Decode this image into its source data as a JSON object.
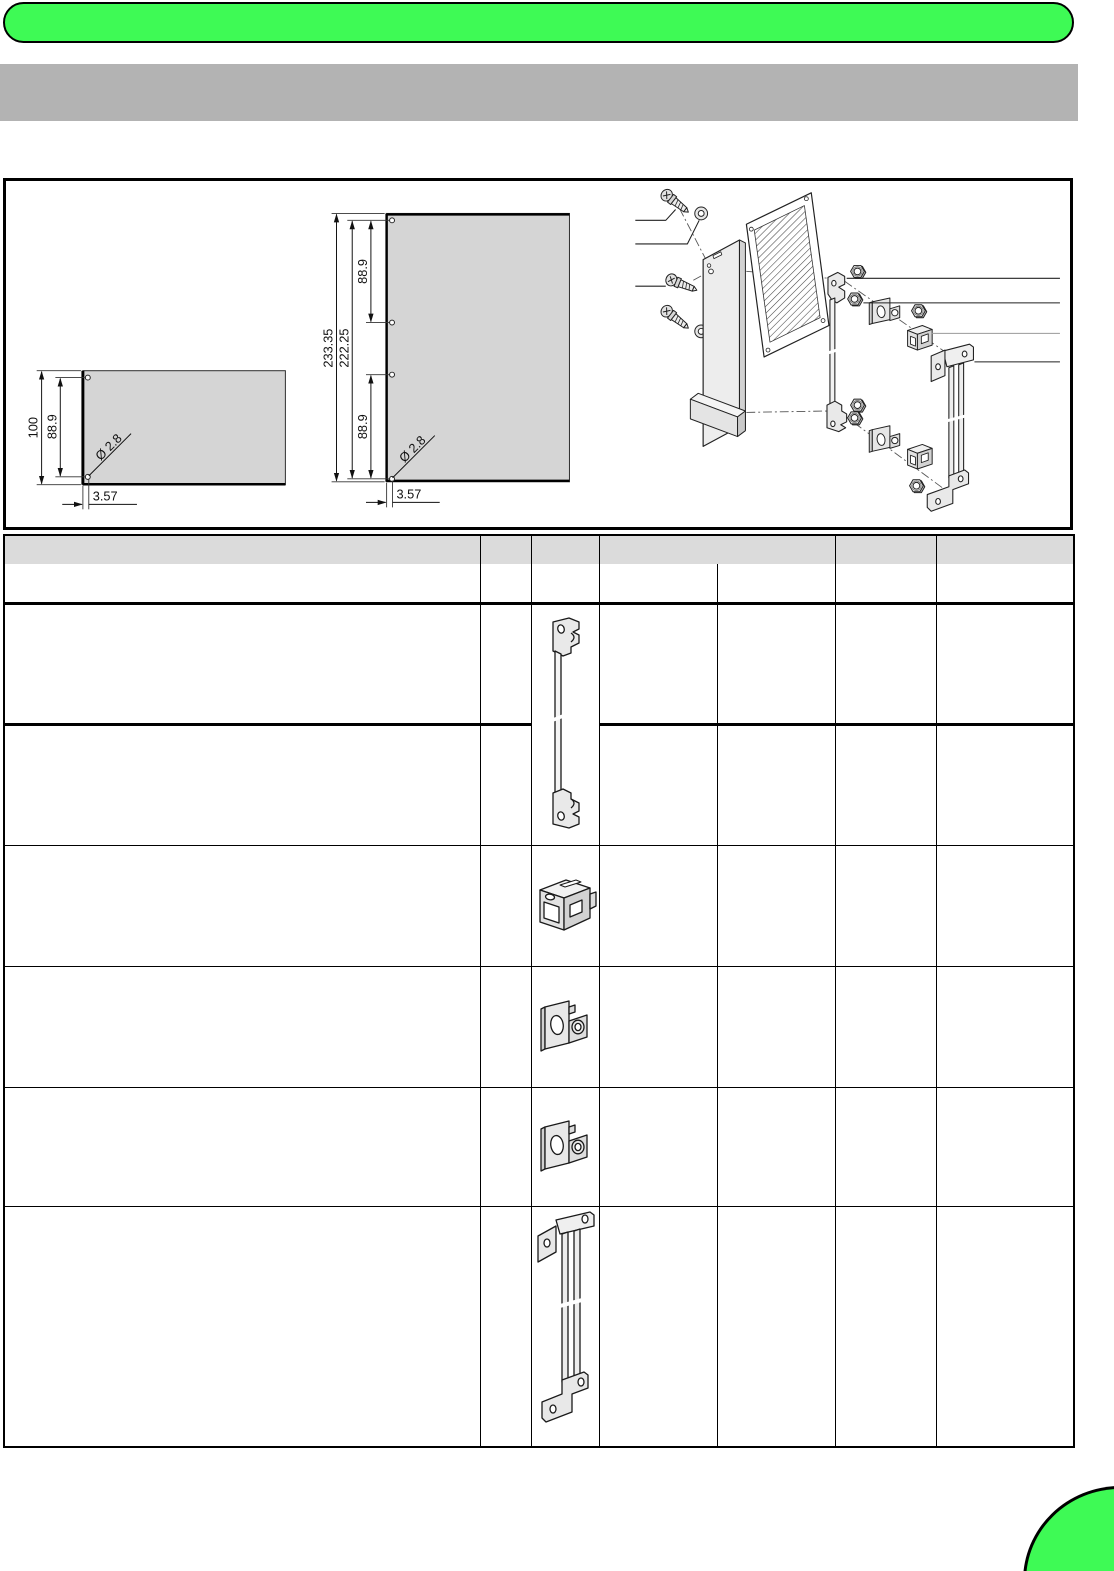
{
  "colors": {
    "accent_green": "#3EFA55",
    "top_bar_gray": "#B3B3B3",
    "table_header_gray": "#DBDBDB",
    "drawing_panel_gray": "#D5D5D5",
    "line_black": "#000000"
  },
  "figure": {
    "small_panel": {
      "overall_height_mm": "100",
      "hole_spacing_mm": "88.9",
      "hole_diameter": "Ø 2.8",
      "hole_edge_offset_mm": "3.57"
    },
    "large_panel": {
      "overall_height_mm": "233.35",
      "hole_span_mm": "222.25",
      "upper_hole_spacing_mm": "88.9",
      "lower_hole_spacing_mm": "88.9",
      "hole_diameter": "Ø 2.8",
      "hole_edge_offset_mm": "3.57"
    },
    "exploded_view_parts": [
      "screw",
      "washer",
      "front-panel-with-handle",
      "perforated-board",
      "card-guide-adapter",
      "hex-nut",
      "oval-hole-clip",
      "cage-clip",
      "mounting-rail-bracket"
    ]
  },
  "table": {
    "header_cells": [
      "",
      "",
      "",
      "",
      "",
      "",
      ""
    ],
    "rows": [
      {
        "icon": "card-guide-adapter-icon",
        "cells": [
          "",
          "",
          "",
          "",
          "",
          ""
        ]
      },
      {
        "icon": "",
        "cells": [
          "",
          "",
          "",
          "",
          "",
          ""
        ]
      },
      {
        "icon": "cage-clip-icon",
        "cells": [
          "",
          "",
          "",
          "",
          "",
          ""
        ]
      },
      {
        "icon": "oval-hole-clip-icon",
        "cells": [
          "",
          "",
          "",
          "",
          "",
          ""
        ]
      },
      {
        "icon": "oval-hole-clip-icon",
        "cells": [
          "",
          "",
          "",
          "",
          "",
          ""
        ]
      },
      {
        "icon": "mounting-rail-bracket-icon",
        "cells": [
          "",
          "",
          "",
          "",
          "",
          ""
        ]
      }
    ]
  }
}
